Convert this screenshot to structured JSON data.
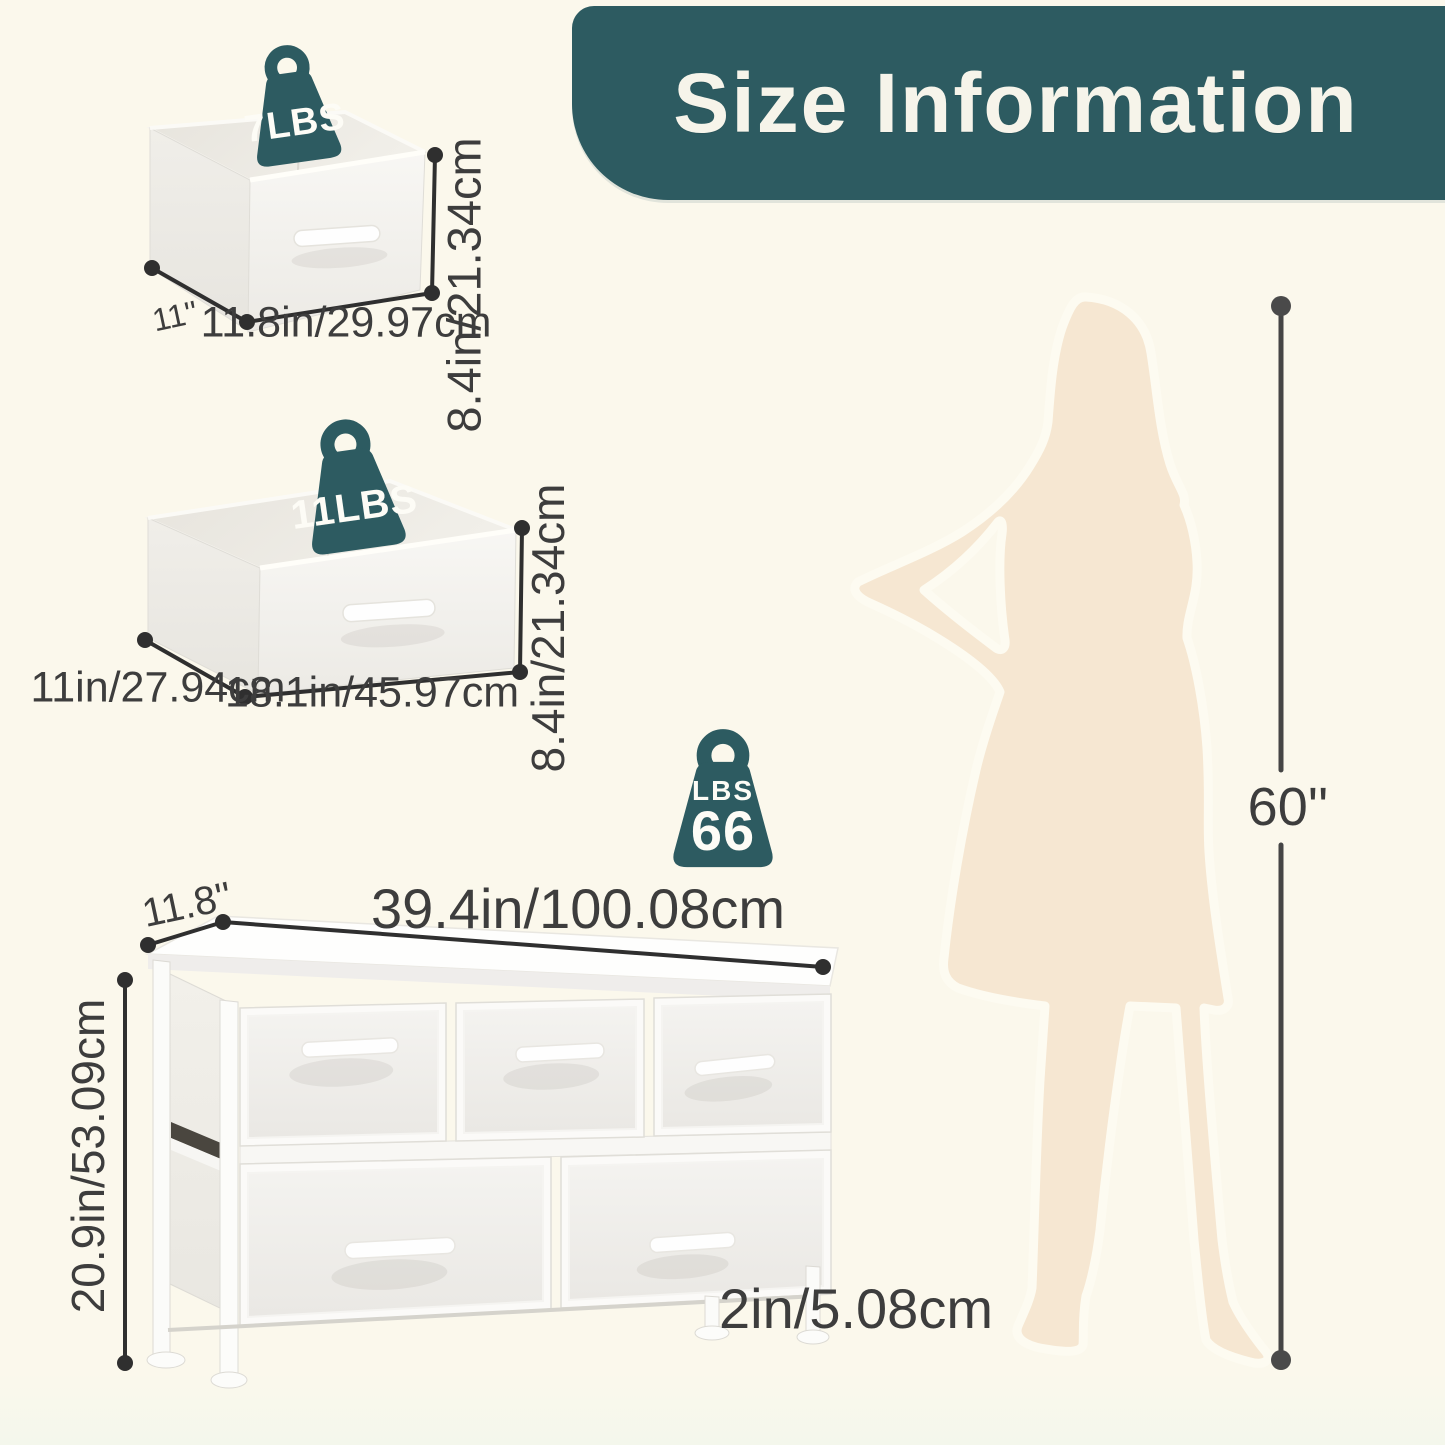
{
  "header": {
    "title": "Size Information"
  },
  "colors": {
    "teal": "#2d5b61",
    "background": "#fbf8ec",
    "text": "#3d3d3d",
    "line": "#2f2f2f",
    "silhouette": "#f6e7d2"
  },
  "small_drawer": {
    "weight_label": "7LBS",
    "depth_label": "11''",
    "width_label": "11.8in/29.97cm",
    "height_label": "8.4in/21.34cm"
  },
  "large_drawer": {
    "weight_label": "11LBS",
    "depth_label": "11in/27.94cm",
    "width_label": "18.1in/45.97cm",
    "height_label": "8.4in/21.34cm"
  },
  "dresser": {
    "weight_unit_label": "LBS",
    "weight_value_label": "66",
    "depth_label": "11.8''",
    "width_label": "39.4in/100.08cm",
    "height_label": "20.9in/53.09cm",
    "leg_height_label": "2in/5.08cm"
  },
  "person": {
    "height_label": "60''"
  }
}
